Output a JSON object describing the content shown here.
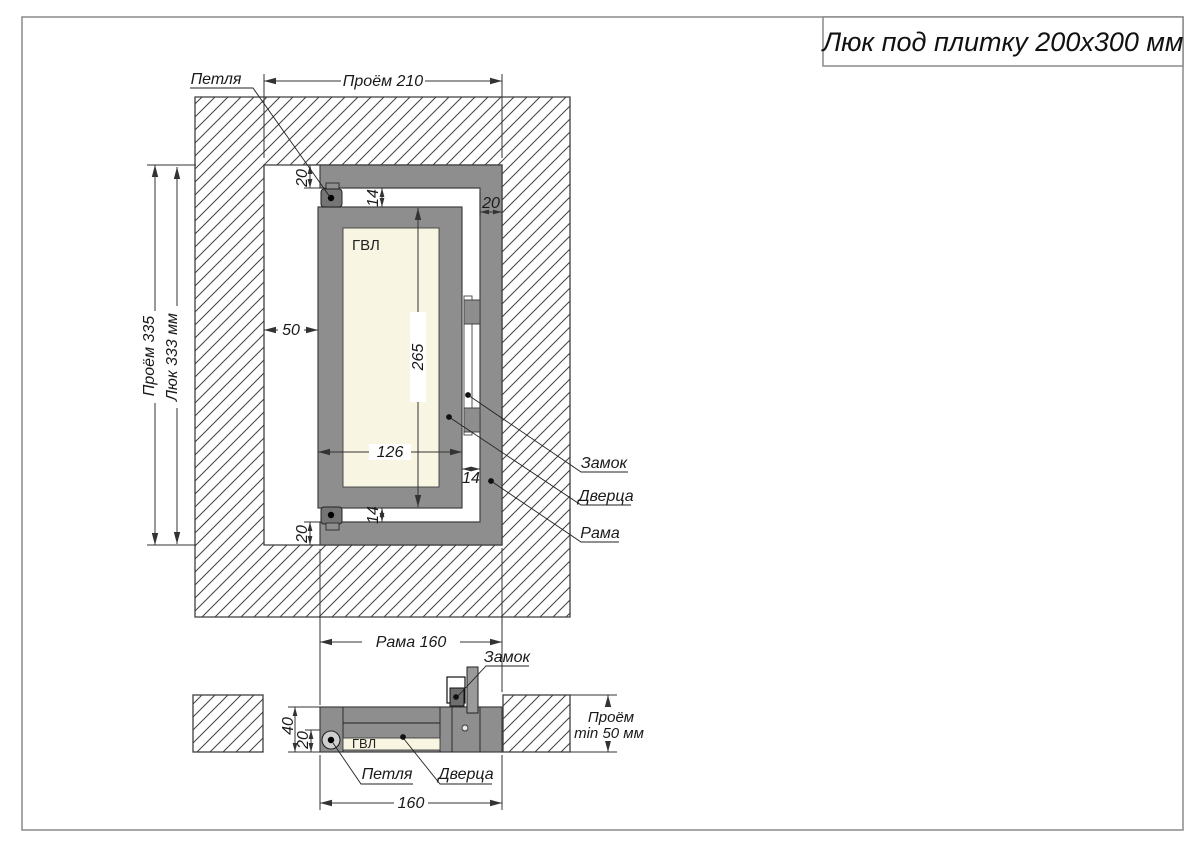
{
  "title": "Люк под плитку 200х300 мм",
  "front": {
    "hinge_label": "Петля",
    "lock_label": "Замок",
    "door_label": "Дверца",
    "frame_label": "Рама",
    "gvl_label": "ГВЛ",
    "dim_opening_width": "Проём 210",
    "dim_opening_height": "Проём 335",
    "dim_hatch_height": "Люк 333 мм",
    "dim_gap_left": "50",
    "dim_door_height": "265",
    "dim_door_width": "126",
    "dim_gap_top": "14",
    "dim_gap_bottom": "14",
    "dim_gap_right": "14",
    "dim_frame_top": "20",
    "dim_frame_bottom": "20",
    "dim_frame_right": "20",
    "dim_frame_width": "Рама 160"
  },
  "section": {
    "lock_label": "Замок",
    "hinge_label": "Петля",
    "door_label": "Дверца",
    "gvl_label": "ГВЛ",
    "dim_depth_total": "40",
    "dim_depth_front": "20",
    "dim_opening_depth_1": "Проём",
    "dim_opening_depth_2": "min 50 мм",
    "dim_frame_width": "160"
  },
  "colors": {
    "frame_gray": "#8e8e8e",
    "hinge_gray": "#757575",
    "gvl_cream": "#f8f6e2",
    "line_dark": "#3a3a3a",
    "border_gray": "#8a8a8a"
  }
}
